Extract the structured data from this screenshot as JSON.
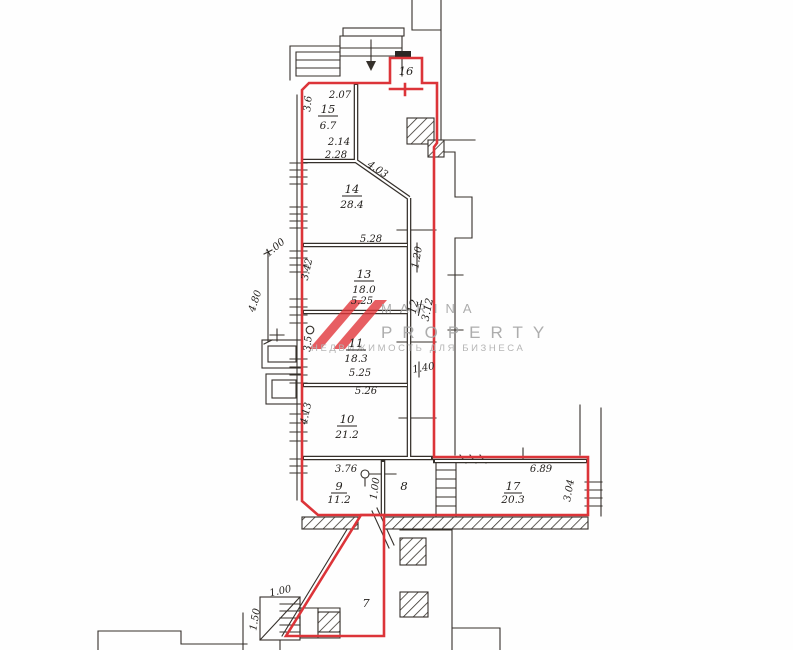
{
  "drawing": {
    "kind": "floor-plan",
    "watermark": {
      "brand_top": "MARINA",
      "brand_bottom": "PROPERTY",
      "tagline": "НЕДВИЖИМОСТЬ ДЛЯ БИЗНЕСА"
    },
    "colors": {
      "boundary_red": "#dc3439",
      "line_dark": "#35302b",
      "watermark_gray": "#a2a2a2",
      "logo_red": "#e13438",
      "paper": "#fefefe"
    },
    "rooms": {
      "r7": {
        "number": "7"
      },
      "r8": {
        "number": "8"
      },
      "r9": {
        "number": "9",
        "area": "11.2"
      },
      "r10": {
        "number": "10",
        "area": "21.2"
      },
      "r11": {
        "number": "11",
        "area": "18.3"
      },
      "r12": {
        "number": "12",
        "area": "3.12"
      },
      "r13": {
        "number": "13",
        "area": "18.0"
      },
      "r14": {
        "number": "14",
        "area": "28.4"
      },
      "r15": {
        "number": "15",
        "area": "6.7"
      },
      "r16": {
        "number": "16"
      },
      "r17": {
        "number": "17",
        "area": "20.3"
      }
    },
    "dims": {
      "d207": "2.07",
      "d36": "3.6",
      "d214": "2.14",
      "d228": "2.28",
      "d403": "4.03",
      "d528": "5.28",
      "d342": "3.42",
      "d525a": "5.25",
      "d35": "3.5",
      "d525b": "5.25",
      "d526": "5.26",
      "d413": "4.13",
      "d120": "1.20",
      "d140": "1.40",
      "d376": "3.76",
      "d100door": "1.00",
      "d689": "6.89",
      "d304": "3.04",
      "d480": "4.80",
      "d100left": "1.00",
      "d100stairs": "1.00",
      "d150stairs": "1.50"
    }
  }
}
